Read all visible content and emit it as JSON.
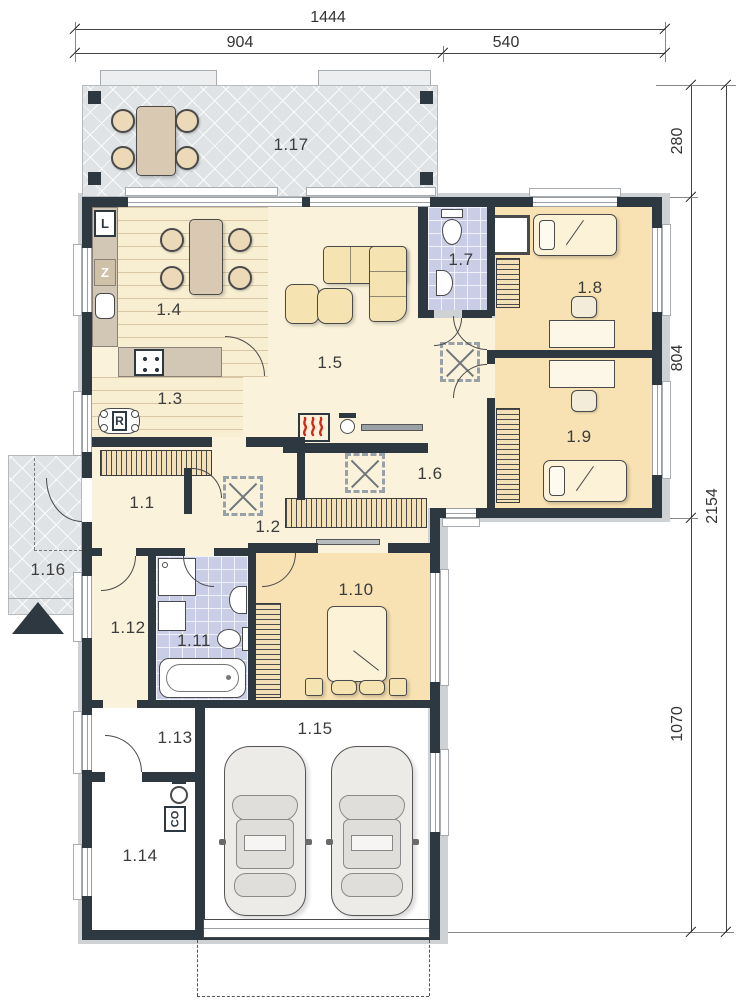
{
  "dimensions": {
    "top": [
      {
        "label": "1444"
      },
      {
        "label": "904"
      },
      {
        "label": "540"
      }
    ],
    "right": [
      {
        "label": "280"
      },
      {
        "label": "804"
      },
      {
        "label": "1070"
      },
      {
        "label": "2154"
      }
    ]
  },
  "rooms": [
    {
      "label": "1.1"
    },
    {
      "label": "1.2"
    },
    {
      "label": "1.3"
    },
    {
      "label": "1.4"
    },
    {
      "label": "1.5"
    },
    {
      "label": "1.6"
    },
    {
      "label": "1.7"
    },
    {
      "label": "1.8"
    },
    {
      "label": "1.9"
    },
    {
      "label": "1.10"
    },
    {
      "label": "1.11"
    },
    {
      "label": "1.12"
    },
    {
      "label": "1.13"
    },
    {
      "label": "1.14"
    },
    {
      "label": "1.15"
    },
    {
      "label": "1.16"
    },
    {
      "label": "1.17"
    }
  ],
  "appliances": {
    "l": "L",
    "z": "Z",
    "r": "R",
    "co": "CO"
  },
  "colors": {
    "wall": "#2d3840",
    "floor_cream": "#faf2da",
    "floor_bedroom": "#f8e2b3",
    "floor_bath": "#c9cde6",
    "terrace": "#e0e3e5",
    "furniture": "#f6e3b2",
    "flame_red": "#d6281a"
  }
}
